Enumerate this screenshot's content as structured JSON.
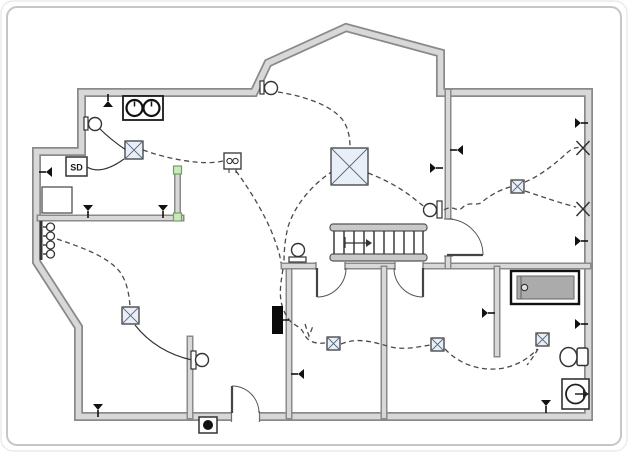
{
  "labels": {
    "smoke_detector": "SD"
  },
  "colors": {
    "wall_edge": "#8a8a8a",
    "wall_fill": "#d8d8d8",
    "wire": "#4a4a4a",
    "solid_wire": "#333333",
    "light_fill": "#e9eff8",
    "light_edge": "#2f2f2f",
    "handle_fill": "#cde8c0",
    "handle_stroke": "#6aa84f",
    "tub_fill": "#ababab",
    "frame": "#c6c6c6",
    "symbol": "#222222"
  },
  "plan": {
    "exterior_path": "M81.5,92.5 L254,92.5 L268,63 L346,27.5 L440.5,53 L440.5,92.5 L588.5,92.5 L588.5,416.5 L78.5,416.5 L78.5,327 L36.5,262 L36.5,151.5 L81.5,151.5 Z",
    "interior_walls": [
      {
        "name": "wall-hall-left",
        "s": [
          40,
          218,
          181,
          218
        ]
      },
      {
        "name": "wall-stub-selected",
        "s": [
          177.5,
          169,
          177.5,
          218
        ]
      },
      {
        "name": "wall-stub-lower-left",
        "s": [
          190,
          339,
          190,
          416
        ]
      },
      {
        "name": "wall-center-vertical",
        "s": [
          289,
          266,
          289,
          416
        ]
      },
      {
        "name": "wall-stair-hall",
        "s": [
          284,
          266,
          588,
          266
        ]
      },
      {
        "name": "wall-right-room",
        "s": [
          448,
          92,
          448,
          266
        ]
      },
      {
        "name": "wall-bottom-divider",
        "s": [
          384,
          269,
          384,
          416
        ]
      },
      {
        "name": "wall-bath-partial",
        "s": [
          497,
          269,
          497,
          354
        ]
      }
    ],
    "openings": [
      [
        231.5,
        411.5,
        28,
        10
      ],
      [
        316,
        261.5,
        29,
        9
      ],
      [
        395,
        261.5,
        28,
        9
      ],
      [
        444,
        219,
        9,
        37
      ]
    ],
    "jambs": [
      [
        231.5,
        411,
        231.5,
        422
      ],
      [
        259.5,
        411,
        259.5,
        422
      ],
      [
        316,
        262,
        316,
        270
      ],
      [
        345,
        262,
        345,
        270
      ],
      [
        395,
        262,
        395,
        270
      ],
      [
        423,
        262,
        423,
        270
      ],
      [
        444,
        219,
        453,
        219
      ],
      [
        444,
        256,
        453,
        256
      ]
    ],
    "doors": [
      {
        "name": "entry-door",
        "leaf": [
          232,
          413,
          232,
          386
        ],
        "arc": "M232,386 A27,27 0 0 1 259,413"
      },
      {
        "name": "door-bottom-left-room",
        "leaf": [
          317,
          268,
          317,
          297
        ],
        "arc": "M317,297 A29,29 0 0 0 346,268"
      },
      {
        "name": "door-bottom-middle-room",
        "leaf": [
          423,
          268,
          423,
          297
        ],
        "arc": "M423,297 A29,29 0 0 1 394,268"
      },
      {
        "name": "door-right-room",
        "leaf": [
          447,
          255,
          483,
          255
        ],
        "arc": "M483,255 A36,36 0 0 0 447,219"
      }
    ],
    "stairs": {
      "rails": [
        [
          330,
          224,
          97,
          7
        ],
        [
          330,
          254,
          97,
          7
        ]
      ],
      "tread_xs": [
        334,
        344,
        354,
        364,
        374,
        384,
        394,
        404,
        414,
        423
      ],
      "tread_y": [
        231,
        254
      ],
      "arrow_path": "M345,237 L345,248 M345,243 L366,243",
      "arrow_head": "366,239 372,243 366,247"
    },
    "wires_dashed": [
      "M143,150 C168,159 204,166 223,161",
      "M236,171 C250,190 266,216 274,238 C278,249 280,255 281,263",
      "M333,171 C314,183 295,204 288,227 C285,239 284,251 284,263",
      "M283,269 C280,287 278,301 286,315 C292,327 300,324 304,334 C308,342 316,344 325,343",
      "M305,324 L309,336 L313,326",
      "M278,92 C303,96 329,104 342,119 C348,127 350,137 350,147",
      "M368,173 C389,181 405,191 417,201 C422,205 426,208 429,210",
      "M444,210 C453,204 457,213 462,208 C470,200 477,207 482,202 C493,193 503,189 510,187",
      "M525,182 C542,175 557,162 568,152 C574,147 578,147 582,148",
      "M525,191 C543,197 560,203 576,207",
      "M57,239 C84,248 108,257 120,272 C127,282 129,294 130,306",
      "M341,344 C358,337 373,342 391,347 C405,350 418,347 430,345",
      "M445,349 C459,364 478,370 496,369 C513,368 529,359 537,349",
      "M538,349 C534,356 531,360 527,365"
    ],
    "wires_solid": [
      "M99,128 C109,138 117,144 126,150",
      "M87,167 C99,174 113,167 124,159",
      "M135,325 C149,343 169,355 192,360",
      "M298,257 L298,262"
    ],
    "ceiling_lights": [
      {
        "name": "ceiling-light",
        "r": [
          125,
          141,
          18
        ]
      },
      {
        "name": "ceiling-light-large",
        "r": [
          331,
          148,
          37
        ]
      },
      {
        "name": "ceiling-light",
        "r": [
          122,
          307,
          17
        ]
      },
      {
        "name": "ceiling-light",
        "r": [
          511,
          180,
          13
        ]
      },
      {
        "name": "ceiling-light",
        "r": [
          327,
          337,
          13
        ]
      },
      {
        "name": "ceiling-light",
        "r": [
          431,
          338,
          13
        ]
      },
      {
        "name": "ceiling-light",
        "r": [
          536,
          333,
          13
        ]
      }
    ],
    "switches": [
      [
        108,
        100,
        180
      ],
      [
        45,
        172,
        90
      ],
      [
        88,
        212,
        0
      ],
      [
        163,
        212,
        0
      ],
      [
        98,
        411,
        0
      ],
      [
        437,
        168,
        270
      ],
      [
        456,
        150,
        90
      ],
      [
        582,
        123,
        270
      ],
      [
        582,
        241,
        270
      ],
      [
        582,
        324,
        270
      ],
      [
        489,
        313,
        270
      ],
      [
        546,
        407,
        0
      ],
      [
        297,
        374,
        90
      ]
    ],
    "wall_outlets_x": [
      [
        583,
        148
      ],
      [
        583,
        209
      ]
    ],
    "junction_box": {
      "r": [
        224,
        153,
        17,
        16
      ],
      "circles": [
        [
          229.5,
          161
        ],
        [
          235.5,
          161
        ]
      ],
      "stems": [
        [
          229,
          169,
          229,
          173
        ],
        [
          236,
          169,
          236,
          173
        ]
      ]
    },
    "appliance_double": {
      "r": [
        123,
        96,
        40,
        24
      ],
      "circles": [
        [
          134.5,
          108
        ],
        [
          151.5,
          108
        ]
      ],
      "cr": 8
    },
    "sd_box": {
      "r": [
        66,
        157,
        21,
        19
      ]
    },
    "closet_box": {
      "r": [
        42,
        187,
        30,
        26
      ]
    },
    "hook_strip": {
      "bar": [
        41,
        221,
        41,
        260
      ],
      "ys": [
        227,
        236,
        245,
        254
      ],
      "cx": 50.5,
      "cr": 4
    },
    "panel_box": {
      "r": [
        272,
        306,
        11,
        28
      ],
      "tick": [
        283,
        320,
        289,
        320
      ]
    },
    "doorbell": {
      "r": [
        199,
        417,
        18,
        16
      ],
      "dot": [
        208,
        425,
        5
      ]
    },
    "exhaust_fan": {
      "r": [
        562,
        379,
        27,
        30
      ],
      "c": [
        575.5,
        394,
        9.5
      ],
      "arrow": [
        575,
        394,
        585,
        394
      ],
      "head": "583,390 589,394 583,398"
    },
    "toilet": {
      "bowl": [
        568.5,
        357,
        8.5,
        9.5
      ],
      "tank": [
        577,
        348,
        11,
        17.5
      ]
    },
    "bathtub": {
      "outer": [
        511,
        271,
        68,
        33
      ],
      "inner": [
        517,
        276,
        57,
        23
      ],
      "divider": [
        521,
        276,
        521,
        299
      ],
      "drain": [
        524.5,
        287.5,
        3.2
      ]
    },
    "wall_lamps": [
      {
        "plate": [
          84,
          117,
          4,
          13
        ],
        "c": [
          95,
          124
        ]
      },
      {
        "plate": [
          260,
          81,
          4,
          13
        ],
        "c": [
          271,
          88
        ]
      },
      {
        "plate": [
          437,
          201,
          5,
          17
        ],
        "c": [
          430,
          210
        ]
      },
      {
        "plate": [
          289,
          257,
          17,
          5
        ],
        "c": [
          298,
          250
        ]
      },
      {
        "plate": [
          191,
          351,
          5,
          18
        ],
        "c": [
          202,
          360
        ]
      }
    ],
    "selection_handles": [
      [
        173.5,
        166
      ],
      [
        173.5,
        213
      ]
    ]
  }
}
